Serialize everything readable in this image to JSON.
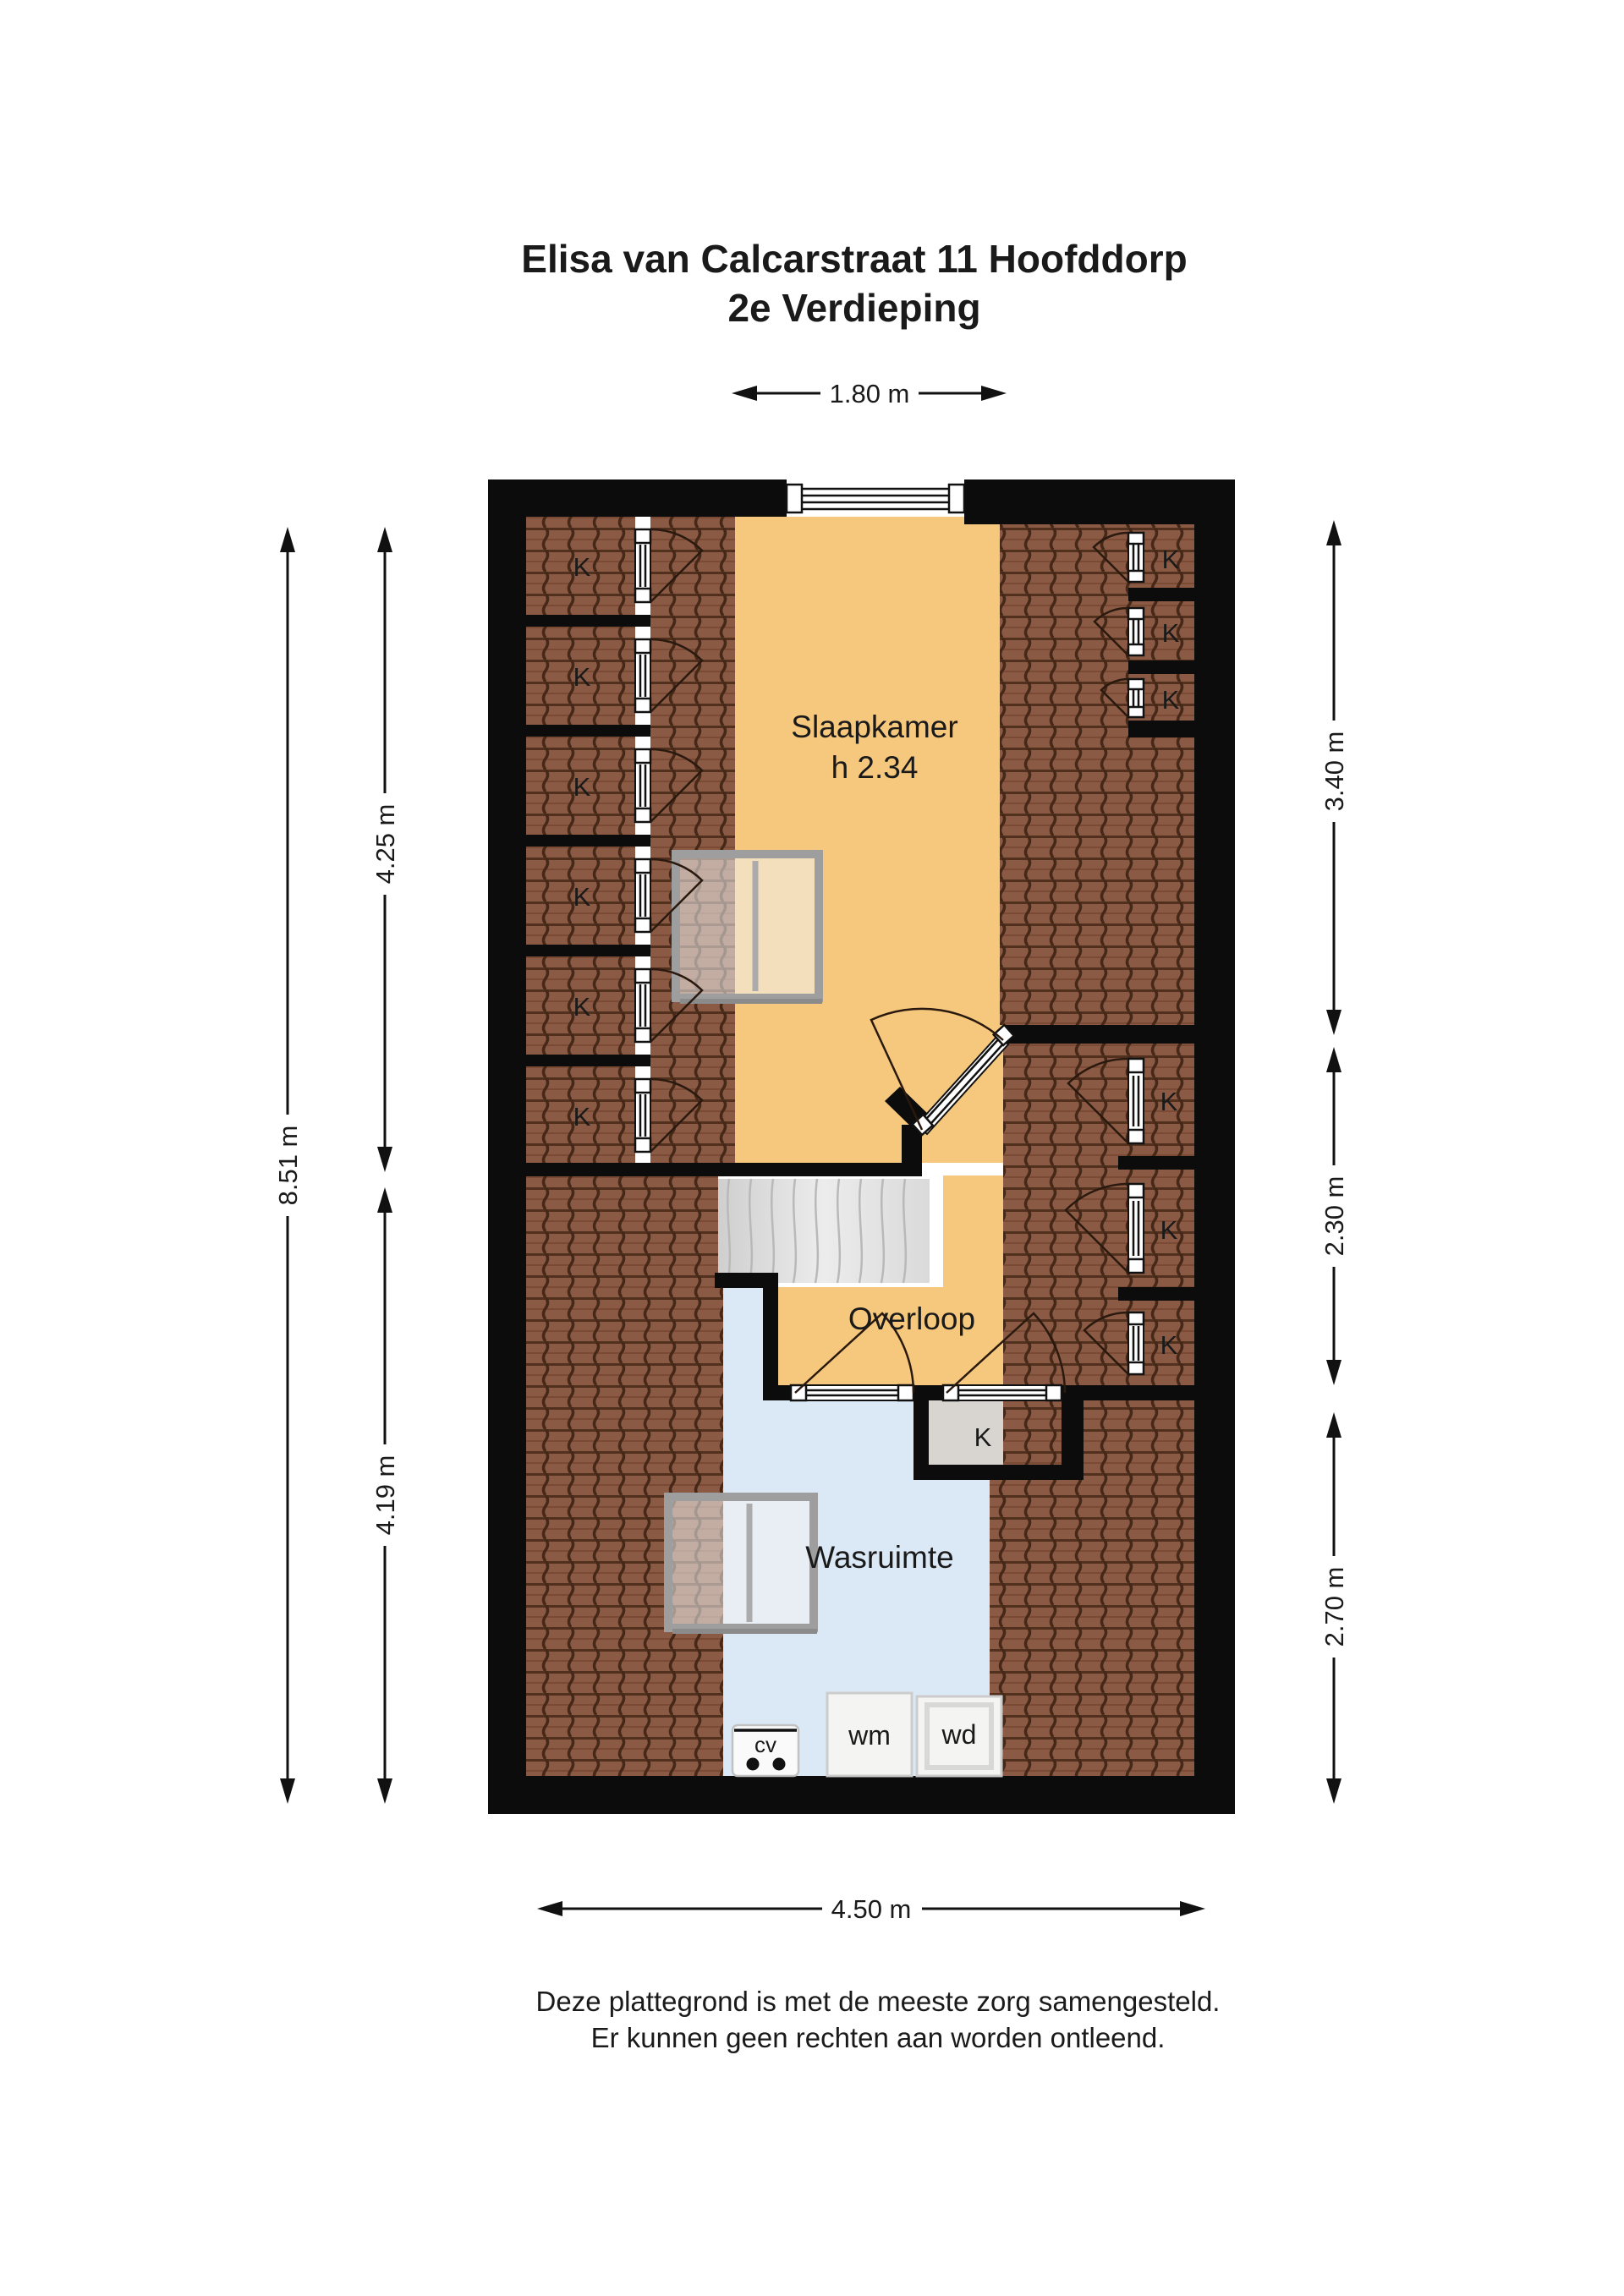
{
  "title": {
    "line1": "Elisa van Calcarstraat 11 Hoofddorp",
    "line2": "2e Verdieping"
  },
  "rooms": {
    "bedroom": {
      "name": "Slaapkamer",
      "height_note": "h 2.34"
    },
    "landing": {
      "name": "Overloop"
    },
    "laundry": {
      "name": "Wasruimte"
    },
    "closet_label": "K",
    "closet_count_visible": 13
  },
  "appliances": {
    "boiler": "cv",
    "washing_machine": "wm",
    "dryer": "wd"
  },
  "dimensions": {
    "top_window": "1.80 m",
    "left_total": "8.51 m",
    "left_upper": "4.25 m",
    "left_lower": "4.19 m",
    "right_upper": "3.40 m",
    "right_middle": "2.30 m",
    "right_lower": "2.70 m",
    "bottom_total": "4.50 m"
  },
  "footer": {
    "line1": "Deze plattegrond is met de meeste zorg samengesteld.",
    "line2": "Er kunnen geen rechten aan worden ontleend."
  },
  "colors": {
    "wall": "#0c0c0c",
    "floor_orange": "#f5c87d",
    "floor_blue": "#dbe8f5",
    "floor_gray": "#d8d5d1",
    "roof_tile": "#8b5a44",
    "roof_tile_line": "#452817",
    "stairs": "#e2e2e2",
    "text": "#1a1a1a"
  }
}
